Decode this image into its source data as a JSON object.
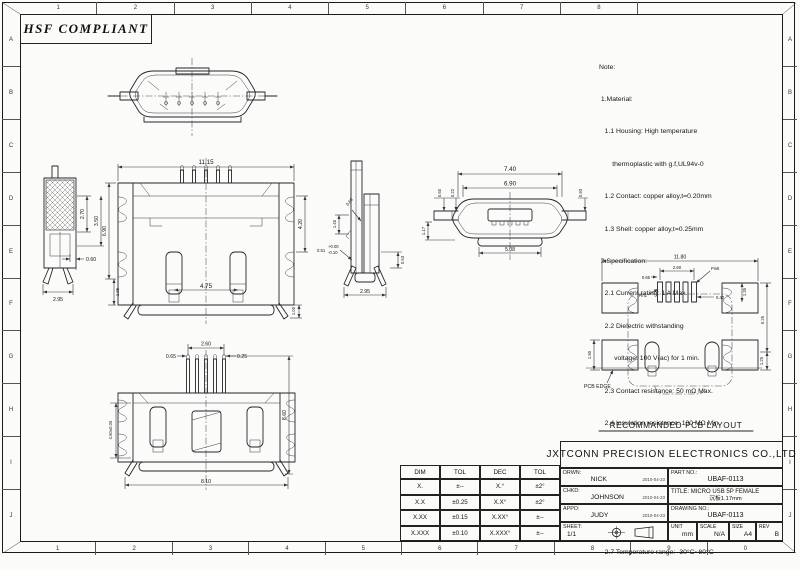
{
  "stamp": {
    "text": "HSF COMPLIANT"
  },
  "border": {
    "top": [
      "1",
      "2",
      "3",
      "4",
      "5",
      "6",
      "7",
      "8"
    ],
    "bottom": [
      "1",
      "2",
      "3",
      "4",
      "5",
      "6",
      "7",
      "8",
      "9",
      "0"
    ],
    "left": [
      "A",
      "B",
      "C",
      "D",
      "E",
      "F",
      "G",
      "H",
      "I",
      "J"
    ],
    "right": [
      "A",
      "B",
      "C",
      "D",
      "E",
      "F",
      "G",
      "H",
      "I",
      "J"
    ]
  },
  "notes": {
    "lines": [
      "Note:",
      " 1.Material:",
      "   1.1 Housing: High temperature",
      "       thermoplastic with g.f,UL94v-0",
      "   1.2 Contact: copper alloy,t=0.20mm",
      "   1.3 Shell: copper alloy,t=0.25mm",
      " 2.Specification:",
      "   2.1 Current rating: 1 A Max.",
      "   2.2 Dielectric withstanding",
      "        voltage: 100 V(ac) for 1 min.",
      "   2.3 Contact resistance: 50 mΩ Max.",
      "   2.4 Insulation resistance: 100 MΩ Min.",
      "   2.5 Total mating force: 3.57 Kgf Max.",
      "   2.6 Total unmating force: 1.0 Kgf Min.0.81~2.05",
      "      Kgf Min.after 10000 insertion/extration cycles",
      "   2.7 Temperature range: -30°C~80°C"
    ]
  },
  "views": {
    "side_left": {
      "d_270": "2.70",
      "d_350": "3.50",
      "d_060": "0.60",
      "d_295": "2.95"
    },
    "top_main": {
      "d_1115": "11.15",
      "d_690": "6.90",
      "d_420": "4.20",
      "d_195": "1.95",
      "d_100": "1.00",
      "d_475": "4.75"
    },
    "side_right": {
      "d_145": "1.45",
      "d_060": "0.60",
      "d_051": "0.51",
      "tol_plus": "+0.00",
      "tol_minus": "-0.10",
      "d_063": "0.63",
      "d_295": "2.95"
    },
    "front": {
      "d_740": "7.40",
      "d_690": "6.90",
      "d_060": "0.60",
      "d_022": "0.22",
      "d_093": "0.93",
      "d_117": "1.17",
      "d_508": "5.08"
    },
    "bottom": {
      "d_260": "2.60",
      "d_065": "0.65",
      "d_025": "0.25",
      "d_450": "4.50±0.05",
      "d_860": "8.60",
      "d_810": "8.10"
    },
    "pcb": {
      "d_1180": "11.80",
      "d_260": "2.60",
      "d_065": "0.65",
      "d_040": "0.40",
      "d_135": "1.35",
      "d_525": "5.25",
      "d_125": "1.25",
      "d_190": "1.90",
      "pin1": "Pin1",
      "pin5": "Pin5",
      "edge_label": "PCB EDGE",
      "caption": "RECOMMANDED PCB LAYOUT"
    }
  },
  "tol_table": {
    "headers": [
      "DIM",
      "TOL",
      "DEC",
      "TOL"
    ],
    "rows": [
      [
        "X.",
        "±--",
        "X.°",
        "±2°"
      ],
      [
        "X.X",
        "±0.25",
        "X.X°",
        "±2°"
      ],
      [
        "X.XX",
        "±0.15",
        "X.XX°",
        "±--"
      ],
      [
        "X.XXX",
        "±0.10",
        "X.XXX°",
        "±--"
      ]
    ]
  },
  "title_block": {
    "company": "JXTCONN PRECISION ELECTRONICS CO.,LTD",
    "drwn_label": "DRWN:",
    "drwn_name": "NICK",
    "drwn_date": "2010-04-23",
    "chkd_label": "CHKD:",
    "chkd_name": "JOHNSON",
    "chkd_date": "2010-04-23",
    "appo_label": "APPO:",
    "appo_name": "JUDY",
    "appo_date": "2010-04-23",
    "sheet_label": "SHEET:",
    "sheet_value": "1/1",
    "part_no_label": "PART NO.:",
    "part_no": "UBAF-0113",
    "title_label": "TITLE:",
    "title_line1": "MICRO USB 5P FEMALE",
    "title_line2": "沉板1.17mm",
    "drawing_no_label": "DRAWING NO.:",
    "drawing_no": "UBAF-0113",
    "unit_label": "UNIT",
    "unit": "mm",
    "scale_label": "SCALE",
    "scale": "N/A",
    "size_label": "SIZE",
    "size": "A4",
    "rev_label": "REV",
    "rev": "B"
  }
}
